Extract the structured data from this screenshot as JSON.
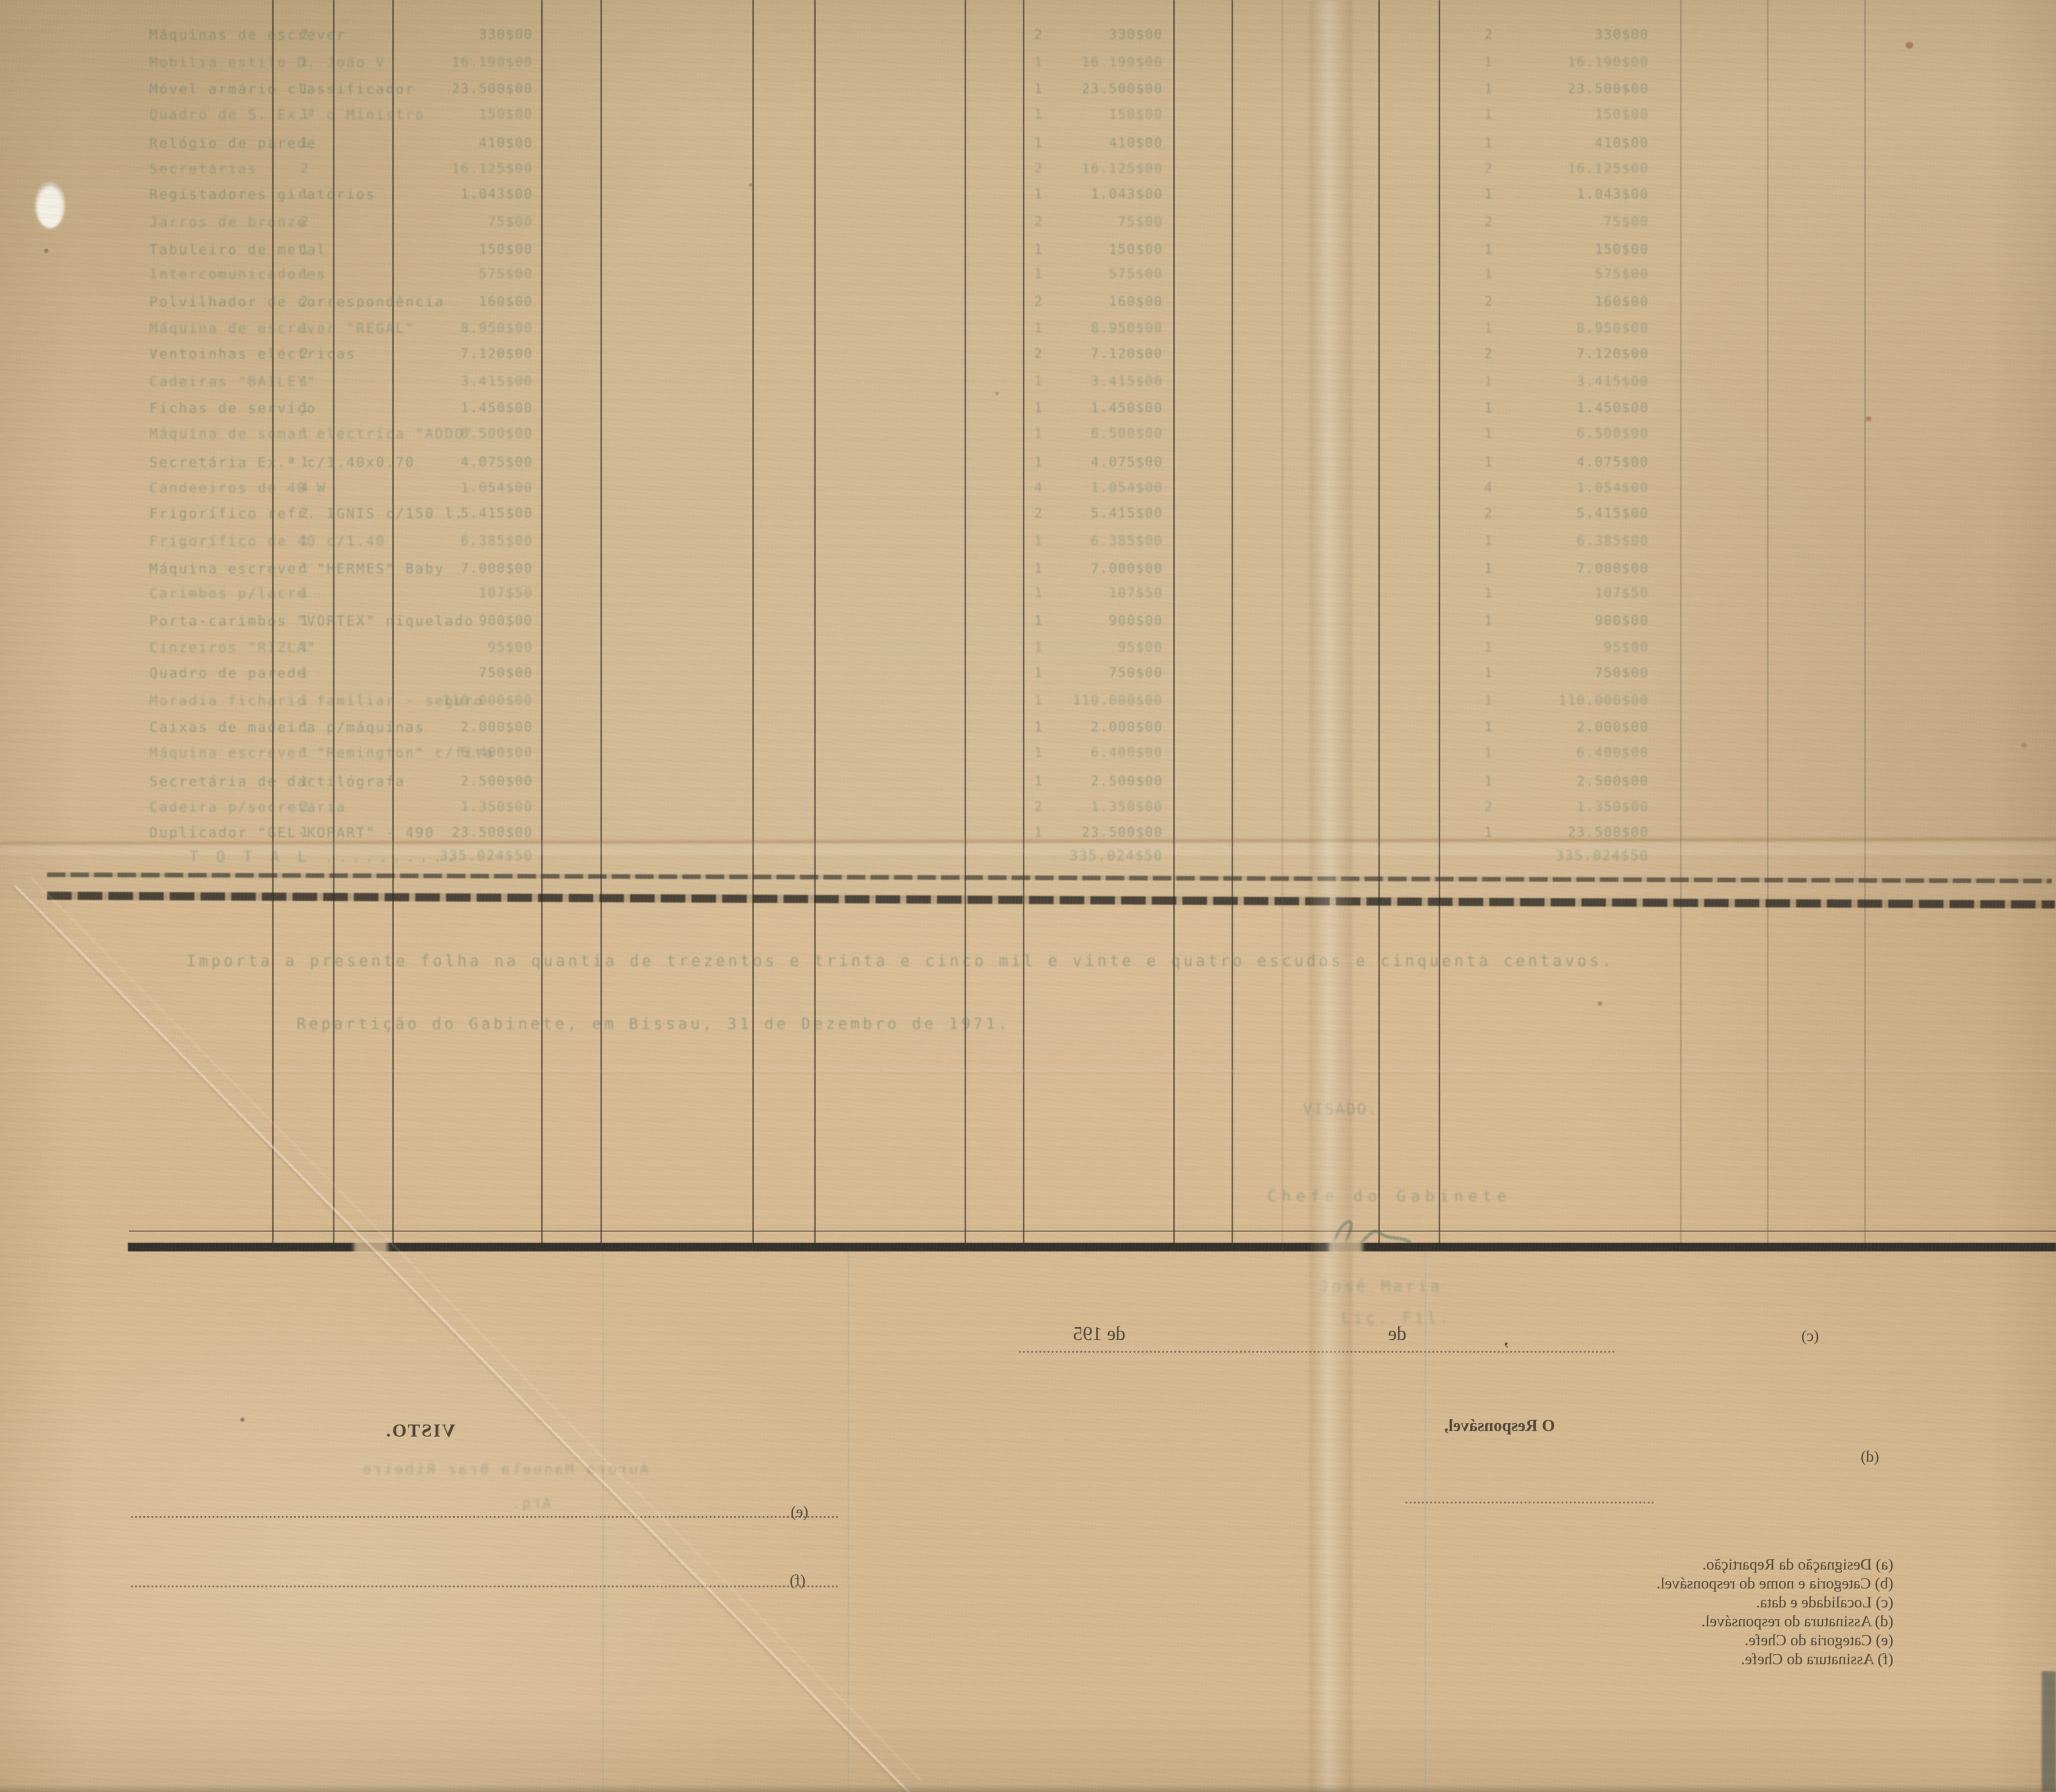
{
  "table": {
    "rows": [
      {
        "name": "Máquinas de escrever",
        "qty": "2",
        "value": "330$00"
      },
      {
        "name": "Mobília estilo D. João V",
        "qty": "1",
        "value": "16.190$00"
      },
      {
        "name": "Móvel armário classificador",
        "qty": "1",
        "value": "23.500$00"
      },
      {
        "name": "Quadro de S. Ex.ª o Ministro",
        "qty": "1",
        "value": "150$00"
      },
      {
        "name": "Relógio de parede",
        "qty": "1",
        "value": "410$00"
      },
      {
        "name": "Secretárias",
        "qty": "2",
        "value": "16.125$00"
      },
      {
        "name": "Registadores giratórios",
        "qty": "1",
        "value": "1.043$00"
      },
      {
        "name": "Jarros de bronze",
        "qty": "2",
        "value": "75$00"
      },
      {
        "name": "Tabuleiro de metal",
        "qty": "1",
        "value": "150$00"
      },
      {
        "name": "Intercomunicadores",
        "qty": "1",
        "value": "575$00"
      },
      {
        "name": "Polvilhador de correspondência",
        "qty": "2",
        "value": "160$00"
      },
      {
        "name": "Máquina de escrever \"REGAL\"",
        "qty": "1",
        "value": "8.950$00"
      },
      {
        "name": "Ventoinhas eléctricas",
        "qty": "2",
        "value": "7.120$00"
      },
      {
        "name": "Cadeiras \"BAILEY\"",
        "qty": "1",
        "value": "3.415$00"
      },
      {
        "name": "Fichas de serviço",
        "qty": "1",
        "value": "1.450$00"
      },
      {
        "name": "Máquina de somar eléctrica \"ADDO\"",
        "qty": "1",
        "value": "6.500$00"
      },
      {
        "name": "Secretária Ex.ª c/1.40x0.70",
        "qty": "1",
        "value": "4.075$00"
      },
      {
        "name": "Candeeiros de 40 W",
        "qty": "4",
        "value": "1.054$00"
      },
      {
        "name": "Frigorífico refr. IGNIS c/150 l.",
        "qty": "2",
        "value": "5.415$00"
      },
      {
        "name": "Frigorífico de 40 c/1.40",
        "qty": "1",
        "value": "6.385$00"
      },
      {
        "name": "Máquina escrever \"HERMES\" Baby",
        "qty": "1",
        "value": "7.000$00"
      },
      {
        "name": "Carimbos p/lacre",
        "qty": "1",
        "value": "107$50"
      },
      {
        "name": "Porta-carimbos \"VORTEX\" niquelado",
        "qty": "1",
        "value": "900$00"
      },
      {
        "name": "Cinzeiros \"RIZLA\"",
        "qty": "1",
        "value": "95$00"
      },
      {
        "name": "Quadro de parede",
        "qty": "1",
        "value": "750$00"
      },
      {
        "name": "Moradia fichário familiar - seguro",
        "qty": "1",
        "value": "110.000$00"
      },
      {
        "name": "Caixas de madeira p/máquinas",
        "qty": "1",
        "value": "2.000$00"
      },
      {
        "name": "Máquina escrever \"Remington\" c/fita",
        "qty": "1",
        "value": "6.400$00"
      },
      {
        "name": "Secretária de dactilógrafa",
        "qty": "1",
        "value": "2.500$00"
      },
      {
        "name": "Cadeira p/secretária",
        "qty": "2",
        "value": "1.350$00"
      },
      {
        "name": "Duplicador \"GEL-KOPART\" - 490",
        "qty": "1",
        "value": "23.500$00"
      }
    ],
    "total_label": "T O T A L ..........",
    "total_value": "335.024$50"
  },
  "summary": {
    "amount_sentence": "Importa a presente folha na quantia de trezentos e trinta e cinco mil e vinte e quatro escudos e cinquenta centavos.",
    "place_date_line": "Repartição do Gabinete, em Bissau, 31 de Dezembro de 1971."
  },
  "approval": {
    "visado": "VISADO.",
    "chief_title": "Chefe do Gabinete",
    "name": "José Maria",
    "degree": "Liç. Fil."
  },
  "verso": {
    "visto": "VISTO.",
    "responsible": "O Responsável,",
    "typed_name": "Aurora Manuela  Braz  Ribeiro",
    "typed_title": "Arq.",
    "date_de195": "de 195",
    "date_de": "de",
    "date_comma": ",",
    "marker_c": "(c)",
    "marker_d": "(d)",
    "marker_e": "(e)",
    "marker_f": "(f)",
    "footnotes": [
      "(a) Designação da Repartição.",
      "(b) Categoria e nome do responsável.",
      "(c) Localidade e data.",
      "(d) Assinatura do responsável.",
      "(e) Categoria do Chefe.",
      "(f) Assinatura do Chefe."
    ]
  },
  "colors": {
    "paper": "#d6ba92",
    "typewriter_teal": "#51756a",
    "print_ink": "#383026",
    "rule_dark": "#3e382d"
  }
}
